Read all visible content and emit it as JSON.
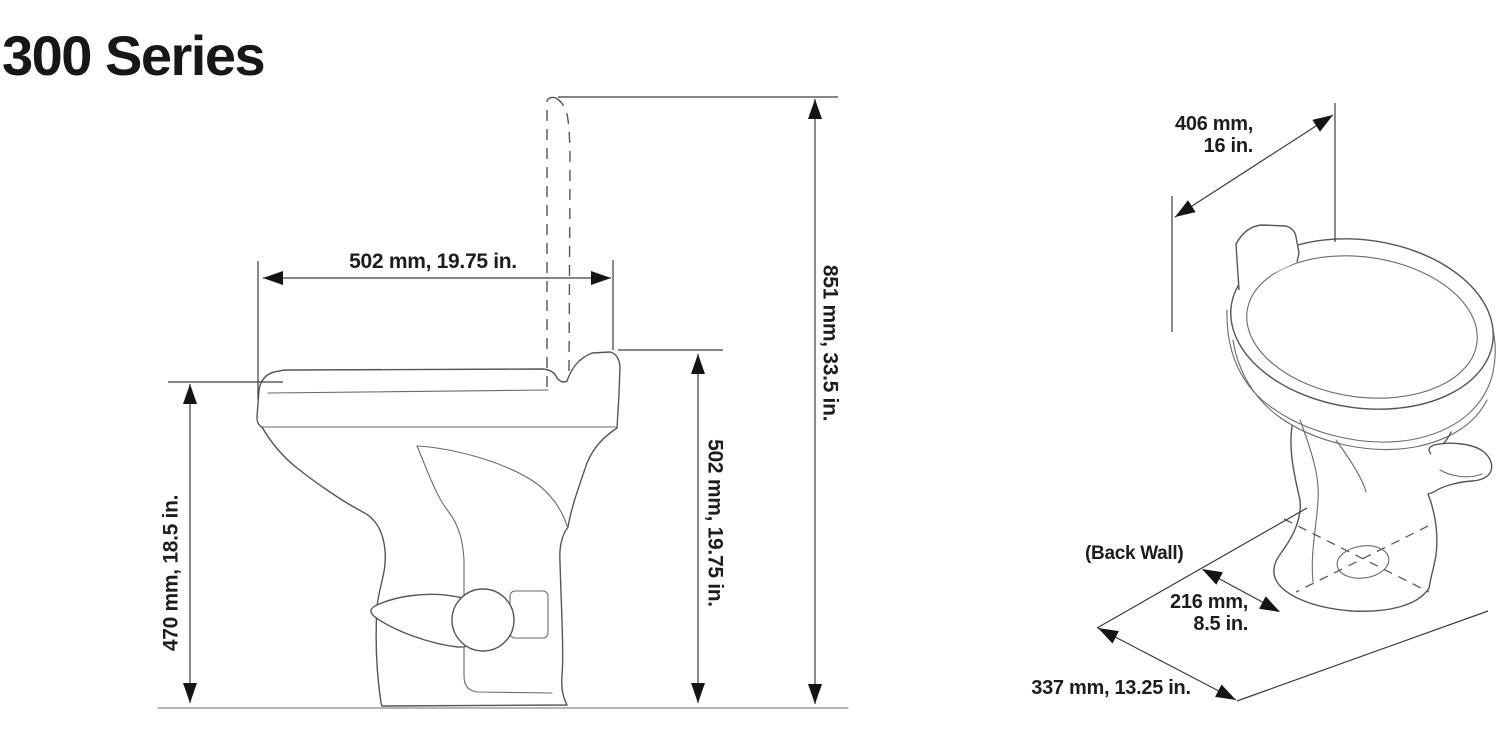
{
  "title": "300 Series",
  "side_view": {
    "width_label": "502 mm, 19.75 in.",
    "total_height_label": "851 mm, 33.5 in.",
    "seat_height_label": "502 mm, 19.75 in.",
    "bowl_height_label": "470 mm, 18.5 in."
  },
  "perspective_view": {
    "seat_width_label_line1": "406 mm,",
    "seat_width_label_line2": "16 in.",
    "back_wall_label": "(Back Wall)",
    "outlet_offset_label_line1": "216 mm,",
    "outlet_offset_label_line2": "8.5 in.",
    "depth_label": "337 mm, 13.25 in."
  },
  "colors": {
    "background": "#ffffff",
    "line": "#565656",
    "dimension_line": "#3c3c3c",
    "text": "#1d1d1d",
    "arrow": "#141414"
  }
}
